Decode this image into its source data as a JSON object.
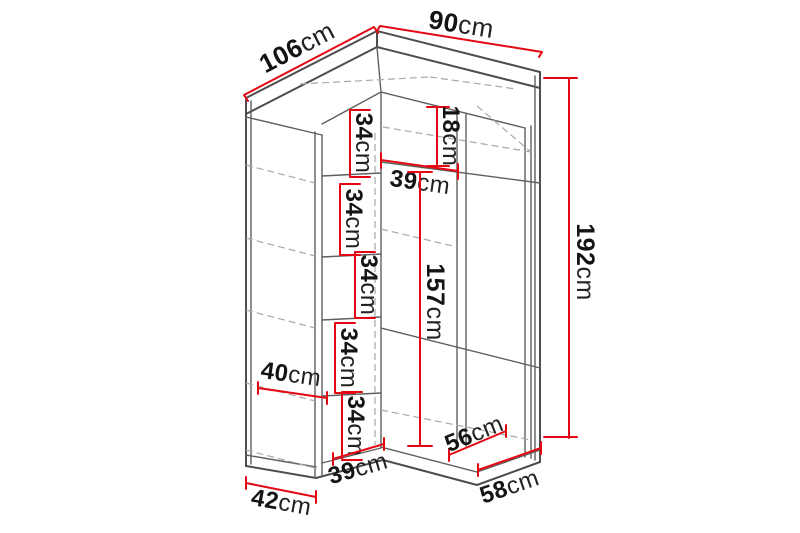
{
  "diagram": {
    "kind": "corner-wardrobe-dimension-drawing",
    "colors": {
      "dimension_line": "#e40613",
      "outline": "#4d4d4d",
      "hidden_line": "#a8a8a8",
      "label_text": "#141414",
      "background": "#ffffff"
    },
    "dims": {
      "d106": {
        "value": "106",
        "unit": "cm"
      },
      "d90": {
        "value": "90",
        "unit": "cm"
      },
      "d192": {
        "value": "192",
        "unit": "cm"
      },
      "d18": {
        "value": "18",
        "unit": "cm"
      },
      "d39_top": {
        "value": "39",
        "unit": "cm"
      },
      "d34_1": {
        "value": "34",
        "unit": "cm"
      },
      "d34_2": {
        "value": "34",
        "unit": "cm"
      },
      "d34_3": {
        "value": "34",
        "unit": "cm"
      },
      "d157": {
        "value": "157",
        "unit": "cm"
      },
      "d34_4": {
        "value": "34",
        "unit": "cm"
      },
      "d40": {
        "value": "40",
        "unit": "cm"
      },
      "d34_5": {
        "value": "34",
        "unit": "cm"
      },
      "d39_bottom": {
        "value": "39",
        "unit": "cm"
      },
      "d56": {
        "value": "56",
        "unit": "cm"
      },
      "d58": {
        "value": "58",
        "unit": "cm"
      },
      "d42": {
        "value": "42",
        "unit": "cm"
      }
    }
  }
}
